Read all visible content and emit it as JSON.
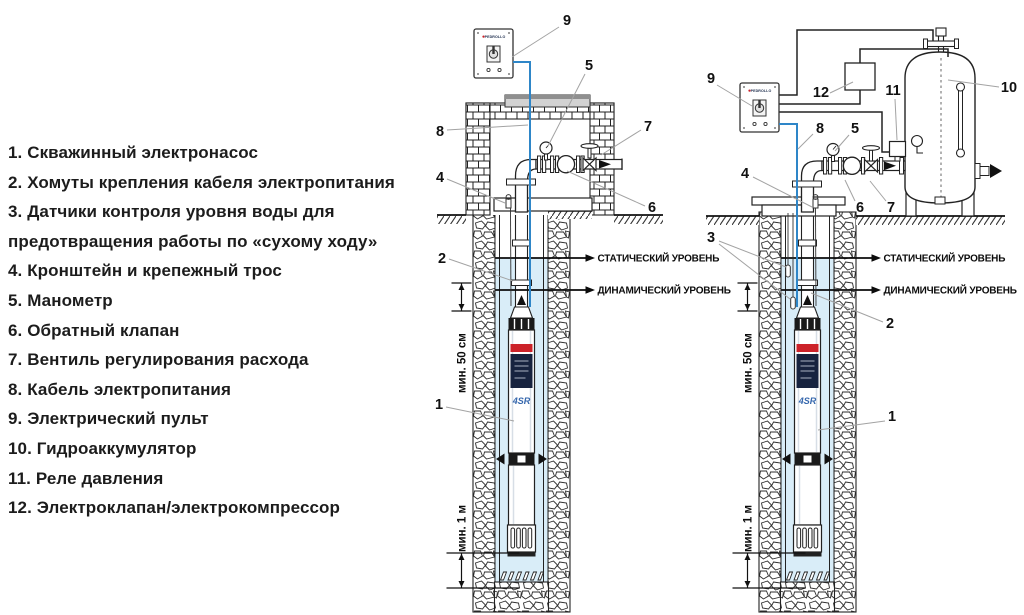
{
  "legend": {
    "items": [
      "1. Скважинный электронасос",
      "2. Хомуты крепления кабеля электропитания",
      "3. Датчики контроля уровня воды для предотвращения работы по «сухому ходу»",
      "4. Кронштейн и крепежный трос",
      "5. Манометр",
      "6. Обратный клапан",
      "7. Вентиль регулирования расхода",
      "8. Кабель электропитания",
      "9. Электрический пульт",
      "10. Гидроаккумулятор",
      "11. Реле давления",
      "12. Электроклапан/электрокомпрессор"
    ]
  },
  "labels": {
    "static_level": "СТАТИЧЕСКИЙ УРОВЕНЬ",
    "dynamic_level": "ДИНАМИЧЕСКИЙ УРОВЕНЬ",
    "min_depth_50": "мин. 50 см",
    "min_depth_1m": "мин. 1 м",
    "pump_model": "4SR",
    "brand": "PEDROLLO"
  },
  "callouts": {
    "c1": "1",
    "c2": "2",
    "c3": "3",
    "c4": "4",
    "c5": "5",
    "c6": "6",
    "c7": "7",
    "c8": "8",
    "c9": "9",
    "c10": "10",
    "c11": "11",
    "c12": "12"
  },
  "colors": {
    "cable_blue": "#2e86c8",
    "water_blue": "#d9edf8",
    "brand_red": "#cc2229",
    "model_blue": "#3567ad"
  }
}
